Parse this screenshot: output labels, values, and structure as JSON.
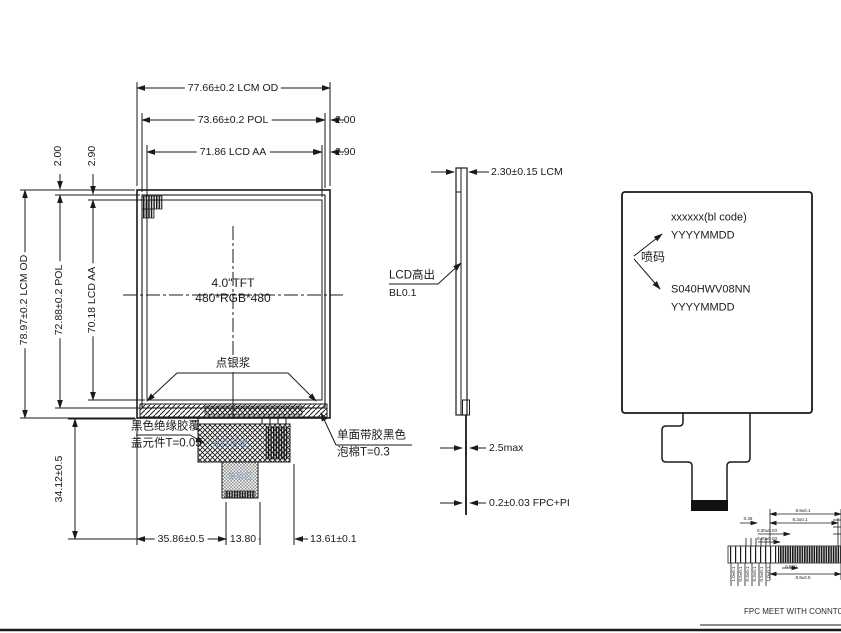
{
  "front_view": {
    "dim_od_h": "77.66±0.2 LCM OD",
    "dim_pol_h": "73.66±0.2 POL",
    "dim_aa_h": "71.86 LCD AA",
    "dim_gap_pol_h": "2.00",
    "dim_gap_aa_h": "2.90",
    "dim_od_v": "78.97±0.2 LCM OD",
    "dim_pol_v": "72.88±0.2 POL",
    "dim_aa_v": "70.18 LCD AA",
    "dim_gap_pol_v": "2.00",
    "dim_gap_aa_v": "2.90",
    "panel_type": "4.0\"TFT",
    "panel_res": "480*RGB*480",
    "silver_paste": "点银浆",
    "insulation_note_1": "黑色绝缘胶覆",
    "insulation_note_2": "盖元件T=0.05",
    "foam_note_1": "单面带胶黑色",
    "foam_note_2": "泡棉T=0.3",
    "component_area": "元件区域",
    "single_layer_area": "单层区",
    "dim_tail_height": "34.12±0.5",
    "dim_bottom_1": "35.86±0.5",
    "dim_bottom_2": "13.80",
    "dim_bottom_3": "13.61±0.1"
  },
  "side_view": {
    "dim_thickness": "2.30±0.15 LCM",
    "lcd_note_1": "LCD高出",
    "lcd_note_2": "BL0.1",
    "dim_component_max": "2.5max",
    "dim_fpc": "0.2±0.03 FPC+PI"
  },
  "back_view": {
    "marking_1": "xxxxxx(bl code)",
    "marking_2": "YYYYMMDD",
    "spray_code": "喷码",
    "marking_3": "S040HWV08NN",
    "marking_4": "YYYYMMDD"
  },
  "detail_view": {
    "note": "FPC MEET WITH CONNTOR;FH26",
    "dims_top": [
      "8.9±0.1",
      "8.3±0.1"
    ],
    "dims_mid": [
      "0.45",
      "0.30±0.03",
      "0.20±0.03"
    ],
    "dims_bottom": [
      "0.5(2)",
      "8.9±0.5"
    ],
    "dims_left": [
      "1.0±0.1",
      "0.5±0.1",
      "0.3±0.1",
      "0.3±0.1",
      "0.5±0.1",
      "1.0±0.1"
    ]
  }
}
